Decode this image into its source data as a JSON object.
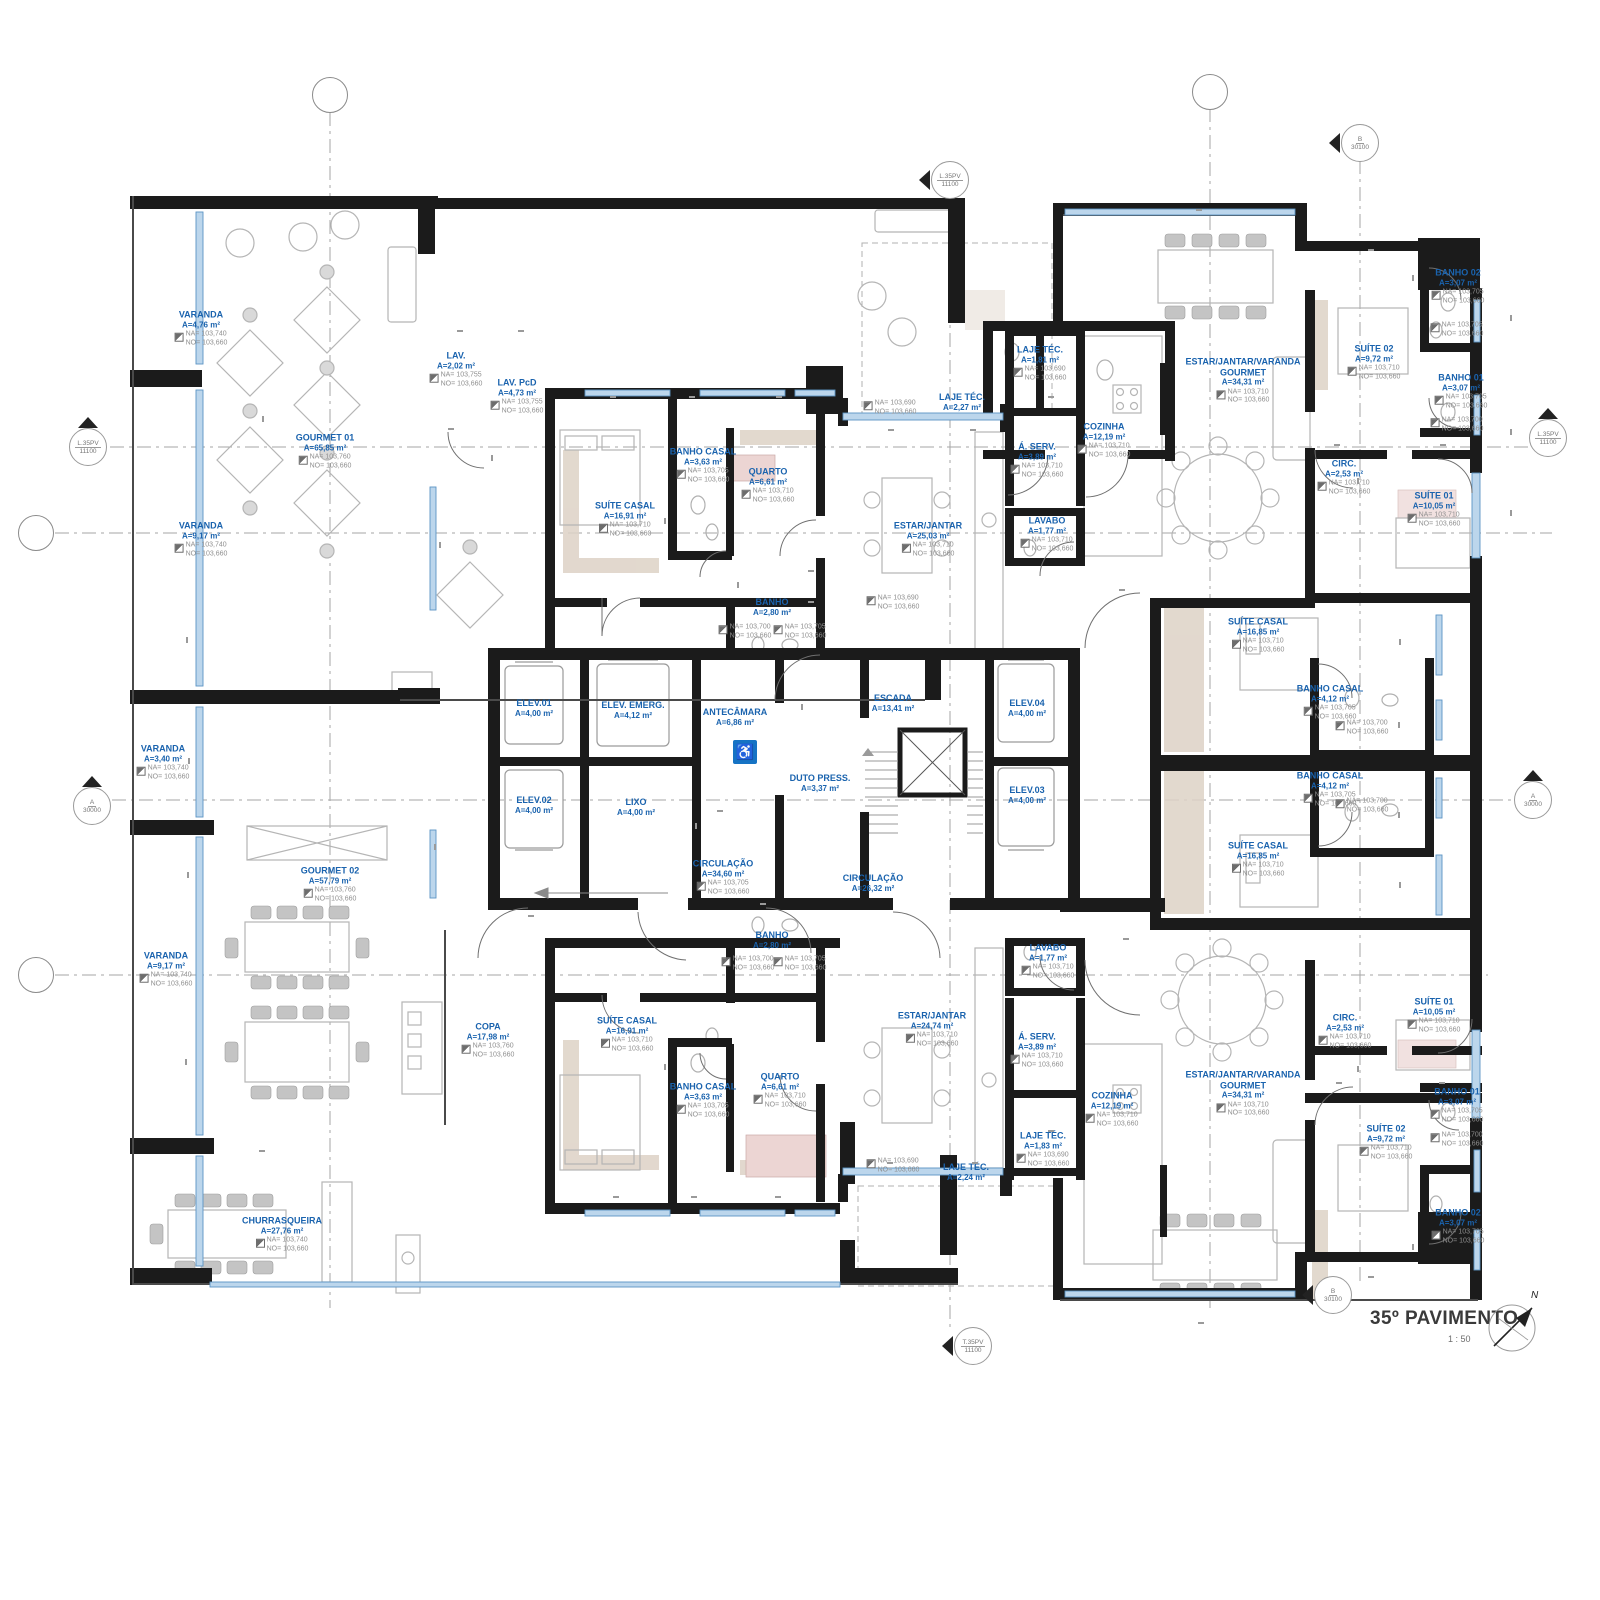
{
  "titleblock": {
    "title": "35º PAVIMENTO",
    "scale": "1 : 50",
    "north": "N"
  },
  "rooms": [
    {
      "name": "VARANDA",
      "area": "A=4,76 m²",
      "na": "NA= 103,740",
      "no": "NO= 103,660",
      "x": 201,
      "y": 329
    },
    {
      "name": "GOURMET 01",
      "area": "A=65,85 m²",
      "na": "NA= 103,760",
      "no": "NO= 103,660",
      "x": 325,
      "y": 452
    },
    {
      "name": "VARANDA",
      "area": "A=9,17 m²",
      "na": "NA= 103,740",
      "no": "NO= 103,660",
      "x": 201,
      "y": 540
    },
    {
      "name": "LAV.",
      "area": "A=2,02 m²",
      "na": "NA= 103,755",
      "no": "NO= 103,660",
      "x": 456,
      "y": 370
    },
    {
      "name": "LAV. PcD",
      "area": "A=4,73 m²",
      "na": "NA= 103,755",
      "no": "NO= 103,660",
      "x": 517,
      "y": 397
    },
    {
      "name": "VARANDA",
      "area": "A=3,40 m²",
      "na": "NA= 103,740",
      "no": "NO= 103,660",
      "x": 163,
      "y": 763
    },
    {
      "name": "GOURMET 02",
      "area": "A=57,79 m²",
      "na": "NA= 103,760",
      "no": "NO= 103,660",
      "x": 330,
      "y": 885
    },
    {
      "name": "VARANDA",
      "area": "A=9,17 m²",
      "na": "NA= 103,740",
      "no": "NO= 103,660",
      "x": 166,
      "y": 970
    },
    {
      "name": "COPA",
      "area": "A=17,98 m²",
      "na": "NA= 103,760",
      "no": "NO= 103,660",
      "x": 488,
      "y": 1041
    },
    {
      "name": "CHURRASQUEIRA",
      "area": "A=27,76 m²",
      "na": "NA= 103,740",
      "no": "NO= 103,660",
      "x": 282,
      "y": 1235
    },
    {
      "name": "SUÍTE CASAL",
      "area": "A=16,91 m²",
      "na": "NA= 103,710",
      "no": "NO= 103,660",
      "x": 625,
      "y": 520
    },
    {
      "name": "BANHO CASAL",
      "area": "A=3,63 m²",
      "na": "NA= 103,705",
      "no": "NO= 103,660",
      "x": 703,
      "y": 466
    },
    {
      "name": "QUARTO",
      "area": "A=6,61 m²",
      "na": "NA= 103,710",
      "no": "NO= 103,660",
      "x": 768,
      "y": 486
    },
    {
      "name": "BANHO",
      "area": "A=2,80 m²",
      "x": 772,
      "y": 607
    },
    {
      "name": "ESTAR/JANTAR",
      "area": "A=25,03 m²",
      "na": "NA= 103,710",
      "no": "NO= 103,660",
      "x": 928,
      "y": 540
    },
    {
      "name": "LAJE TÉC.",
      "area": "A=2,27 m²",
      "x": 962,
      "y": 402
    },
    {
      "name": "LAJE TÉC.",
      "area": "A=1,81 m²",
      "na": "NA= 103,690",
      "no": "NO= 103,660",
      "x": 1040,
      "y": 364
    },
    {
      "name": "Á. SERV.",
      "area": "A=3,89 m²",
      "na": "NA= 103,710",
      "no": "NO= 103,660",
      "x": 1037,
      "y": 461
    },
    {
      "name": "COZINHA",
      "area": "A=12,19 m²",
      "na": "NA= 103,710",
      "no": "NO= 103,660",
      "x": 1104,
      "y": 441
    },
    {
      "name": "LAVABO",
      "area": "A=1,77 m²",
      "na": "NA= 103,710",
      "no": "NO= 103,660",
      "x": 1047,
      "y": 535
    },
    {
      "name": "ESTAR/JANTAR/VARANDA\nGOURMET",
      "area": "A=34,31 m²",
      "na": "NA= 103,710",
      "no": "NO= 103,660",
      "x": 1243,
      "y": 381
    },
    {
      "name": "SUÍTE CASAL",
      "area": "A=16,85 m²",
      "na": "NA= 103,710",
      "no": "NO= 103,660",
      "x": 1258,
      "y": 636
    },
    {
      "name": "BANHO CASAL",
      "area": "A=4,12 m²",
      "na": "NA= 103,705",
      "no": "NO= 103,660",
      "x": 1330,
      "y": 703
    },
    {
      "name": "BANHO CASAL",
      "area": "A=4,12 m²",
      "na": "NA= 103,705",
      "no": "NO= 103,660",
      "x": 1330,
      "y": 790
    },
    {
      "name": "SUÍTE CASAL",
      "area": "A=16,85 m²",
      "na": "NA= 103,710",
      "no": "NO= 103,660",
      "x": 1258,
      "y": 860
    },
    {
      "name": "BANHO 02",
      "area": "A=3,07 m²",
      "na": "NA= 103,705",
      "no": "NO= 103,660",
      "x": 1458,
      "y": 287
    },
    {
      "name": "SUÍTE 02",
      "area": "A=9,72 m²",
      "na": "NA= 103,710",
      "no": "NO= 103,660",
      "x": 1374,
      "y": 363
    },
    {
      "name": "BANHO 01",
      "area": "A=3,07 m²",
      "na": "NA= 103,705",
      "no": "NO= 103,660",
      "x": 1461,
      "y": 392
    },
    {
      "name": "CIRC.",
      "area": "A=2,53 m²",
      "na": "NA= 103,710",
      "no": "NO= 103,660",
      "x": 1344,
      "y": 478
    },
    {
      "name": "SUÍTE 01",
      "area": "A=10,05 m²",
      "na": "NA= 103,710",
      "no": "NO= 103,660",
      "x": 1434,
      "y": 510
    },
    {
      "name": "ELEV.01",
      "area": "A=4,00 m²",
      "x": 534,
      "y": 708
    },
    {
      "name": "ELEV. EMERG.",
      "area": "A=4,12 m²",
      "x": 633,
      "y": 710
    },
    {
      "name": "ANTECÂMARA",
      "area": "A=6,86 m²",
      "x": 735,
      "y": 717
    },
    {
      "name": "ESCADA",
      "area": "A=13,41 m²",
      "x": 893,
      "y": 703
    },
    {
      "name": "ELEV.02",
      "area": "A=4,00 m²",
      "x": 534,
      "y": 805
    },
    {
      "name": "LIXO",
      "area": "A=4,00 m²",
      "x": 636,
      "y": 807
    },
    {
      "name": "DUTO PRESS.",
      "area": "A=3,37 m²",
      "x": 820,
      "y": 783
    },
    {
      "name": "ELEV.04",
      "area": "A=4,00 m²",
      "x": 1027,
      "y": 708
    },
    {
      "name": "ELEV.03",
      "area": "A=4,00 m²",
      "x": 1027,
      "y": 795
    },
    {
      "name": "CIRCULAÇÃO",
      "area": "A=34,60 m²",
      "na": "NA= 103,705",
      "no": "NO= 103,660",
      "x": 723,
      "y": 878
    },
    {
      "name": "CIRCULAÇÃO",
      "area": "A=26,32 m²",
      "x": 873,
      "y": 883
    },
    {
      "name": "BANHO",
      "area": "A=2,80 m²",
      "x": 772,
      "y": 940
    },
    {
      "name": "SUÍTE CASAL",
      "area": "A=16,91 m²",
      "na": "NA= 103,710",
      "no": "NO= 103,660",
      "x": 627,
      "y": 1035
    },
    {
      "name": "BANHO CASAL",
      "area": "A=3,63 m²",
      "na": "NA= 103,705",
      "no": "NO= 103,660",
      "x": 703,
      "y": 1101
    },
    {
      "name": "QUARTO",
      "area": "A=6,61 m²",
      "na": "NA= 103,710",
      "no": "NO= 103,660",
      "x": 780,
      "y": 1091
    },
    {
      "name": "ESTAR/JANTAR",
      "area": "A=24,74 m²",
      "na": "NA= 103,710",
      "no": "NO= 103,660",
      "x": 932,
      "y": 1030
    },
    {
      "name": "LAJE TÉC.",
      "area": "A=2,24 m²",
      "x": 966,
      "y": 1172
    },
    {
      "name": "LAVABO",
      "area": "A=1,77 m²",
      "na": "NA= 103,710",
      "no": "NO= 103,660",
      "x": 1048,
      "y": 962
    },
    {
      "name": "Á. SERV.",
      "area": "A=3,89 m²",
      "na": "NA= 103,710",
      "no": "NO= 103,660",
      "x": 1037,
      "y": 1051
    },
    {
      "name": "COZINHA",
      "area": "A=12,19 m²",
      "na": "NA= 103,710",
      "no": "NO= 103,660",
      "x": 1112,
      "y": 1110
    },
    {
      "name": "LAJE TÉC.",
      "area": "A=1,83 m²",
      "na": "NA= 103,690",
      "no": "NO= 103,660",
      "x": 1043,
      "y": 1150
    },
    {
      "name": "ESTAR/JANTAR/VARANDA\nGOURMET",
      "area": "A=34,31 m²",
      "na": "NA= 103,710",
      "no": "NO= 103,660",
      "x": 1243,
      "y": 1094
    },
    {
      "name": "CIRC.",
      "area": "A=2,53 m²",
      "na": "NA= 103,710",
      "no": "NO= 103,660",
      "x": 1345,
      "y": 1032
    },
    {
      "name": "SUÍTE 01",
      "area": "A=10,05 m²",
      "na": "NA= 103,710",
      "no": "NO= 103,660",
      "x": 1434,
      "y": 1016
    },
    {
      "name": "SUÍTE 02",
      "area": "A=9,72 m²",
      "na": "NA= 103,710",
      "no": "NO= 103,660",
      "x": 1386,
      "y": 1143
    },
    {
      "name": "BANHO 01",
      "area": "A=3,07 m²",
      "na": "NA= 103,705",
      "no": "NO= 103,660",
      "x": 1457,
      "y": 1106
    },
    {
      "name": "BANHO 02",
      "area": "A=3,07 m²",
      "na": "NA= 103,705",
      "no": "NO= 103,660",
      "x": 1458,
      "y": 1227
    }
  ],
  "levels": [
    {
      "na": "NA= 103,700",
      "no": "NO= 103,660",
      "x": 745,
      "y": 632
    },
    {
      "na": "NA= 103,705",
      "no": "NO= 103,660",
      "x": 800,
      "y": 632
    },
    {
      "na": "NA= 103,700",
      "no": "NO= 103,660",
      "x": 748,
      "y": 964
    },
    {
      "na": "NA= 103,705",
      "no": "NO= 103,660",
      "x": 800,
      "y": 964
    },
    {
      "na": "NA= 103,700",
      "no": "NO= 103,660",
      "x": 1362,
      "y": 728
    },
    {
      "na": "NA= 103,700",
      "no": "NO= 103,660",
      "x": 1362,
      "y": 806
    },
    {
      "na": "NA= 103,690",
      "no": "NO= 103,660",
      "x": 893,
      "y": 603
    },
    {
      "na": "NA= 103,690",
      "no": "NO= 103,660",
      "x": 893,
      "y": 1166
    },
    {
      "na": "NA= 103,690",
      "no": "NO= 103,660",
      "x": 890,
      "y": 408
    },
    {
      "na": "NA= 103,705",
      "no": "NO= 103,660",
      "x": 1457,
      "y": 330
    },
    {
      "na": "NA= 103,700",
      "no": "NO= 103,660",
      "x": 1457,
      "y": 425
    },
    {
      "na": "NA= 103,700",
      "no": "NO= 103,660",
      "x": 1457,
      "y": 1140
    }
  ],
  "annotations": [
    {
      "text": "OS ELEVADORES DEVERÃO SEGUIR\nAS RECOMENDAÇÕES PREVISTAS\nNA NORMA NM 313/07",
      "x": 665,
      "y": 252
    },
    {
      "text": "OS ELEVADORES\nDEVERÃO SEGUIR AS\nRECOMENDAÇÕES\nPREVISTAS NA NORMA NM\n313/07",
      "x": 1498,
      "y": 747
    },
    {
      "text": "GUARDA-CORPO\nH=1,20m\nMURETA H=0,60m\nGRADIL H=0,60m",
      "x": 886,
      "y": 320
    },
    {
      "text": "GUARDA-CORPO\nH=1,20m\nMURETA H=0,20m\nGRADIL H=1,00m",
      "x": 976,
      "y": 320
    },
    {
      "text": "GUARDA-CORPO H=1,20m\nMURETA H=0,20m\nGRADIL H=1,00m",
      "x": 1000,
      "y": 252
    },
    {
      "text": "GUARDA-CORPO\nH=1,20m\nMURETA H=0,60m\nGRADIL H=0,60m",
      "x": 886,
      "y": 1253
    },
    {
      "text": "GUARDA-CORPO\nH=1,20m\nMURETA H=0,20m\nGRADIL H=1,00m",
      "x": 976,
      "y": 1253
    },
    {
      "text": "GUARDA-CORPO H=1,20m\nMURETA H=0,20m\nGRADIL H=1,00m",
      "x": 1000,
      "y": 1302
    },
    {
      "text": "VENTILAÇÃO\nMECÂNICA",
      "x": 866,
      "y": 629
    },
    {
      "text": "VENTILAÇÃO\nMECÂNICA",
      "x": 1133,
      "y": 536
    },
    {
      "text": "VENTILAÇÃO\nMECÂNICA",
      "x": 870,
      "y": 966
    },
    {
      "text": "VENTILAÇÃO\nMECÂNICA",
      "x": 1133,
      "y": 998
    },
    {
      "text": "REF",
      "x": 407,
      "y": 687
    },
    {
      "text": "SOBE\ni=2,75%",
      "x": 600,
      "y": 896
    },
    {
      "text": "SOBE",
      "x": 868,
      "y": 739
    },
    {
      "text": "DESCE",
      "x": 916,
      "y": 706,
      "v": 1
    },
    {
      "text": "A=14,37m²",
      "x": 884,
      "y": 512,
      "v": 1
    }
  ],
  "tags": [
    {
      "t": "P22",
      "x": 263,
      "y": 419,
      "v": 1
    },
    {
      "t": "P22",
      "x": 187,
      "y": 640,
      "v": 1
    },
    {
      "t": "P23",
      "x": 189,
      "y": 761,
      "v": 1
    },
    {
      "t": "P22",
      "x": 188,
      "y": 875,
      "v": 1
    },
    {
      "t": "P22",
      "x": 186,
      "y": 1062,
      "v": 1
    },
    {
      "t": "P22",
      "x": 262,
      "y": 1151
    },
    {
      "t": "J14",
      "x": 460,
      "y": 331
    },
    {
      "t": "J14",
      "x": 521,
      "y": 331
    },
    {
      "t": "P01",
      "x": 451,
      "y": 429
    },
    {
      "t": "P05",
      "x": 492,
      "y": 458,
      "v": 1
    },
    {
      "t": "P31",
      "x": 440,
      "y": 545,
      "v": 1
    },
    {
      "t": "P31",
      "x": 435,
      "y": 847,
      "v": 1
    },
    {
      "t": "J07",
      "x": 613,
      "y": 397
    },
    {
      "t": "J14",
      "x": 692,
      "y": 397
    },
    {
      "t": "J06",
      "x": 779,
      "y": 397
    },
    {
      "t": "P01",
      "x": 665,
      "y": 521,
      "v": 1
    },
    {
      "t": "P02",
      "x": 738,
      "y": 585,
      "v": 1
    },
    {
      "t": "P02",
      "x": 811,
      "y": 571
    },
    {
      "t": "P01",
      "x": 811,
      "y": 602
    },
    {
      "t": "P22",
      "x": 891,
      "y": 430
    },
    {
      "t": "P27",
      "x": 973,
      "y": 430
    },
    {
      "t": "P27",
      "x": 1051,
      "y": 397
    },
    {
      "t": "P03A",
      "x": 531,
      "y": 916
    },
    {
      "t": "P03A",
      "x": 763,
      "y": 904
    },
    {
      "t": "P08",
      "x": 696,
      "y": 826,
      "v": 1
    },
    {
      "t": "PCF",
      "x": 720,
      "y": 811
    },
    {
      "t": "PCF",
      "x": 802,
      "y": 707,
      "v": 1
    },
    {
      "t": "P04A",
      "x": 1122,
      "y": 590
    },
    {
      "t": "P04A",
      "x": 1126,
      "y": 939
    },
    {
      "t": "J13",
      "x": 1199,
      "y": 210
    },
    {
      "t": "J13",
      "x": 1201,
      "y": 1323
    },
    {
      "t": "J06",
      "x": 1371,
      "y": 250
    },
    {
      "t": "P01",
      "x": 1413,
      "y": 278,
      "v": 1
    },
    {
      "t": "J14",
      "x": 1511,
      "y": 318,
      "v": 1
    },
    {
      "t": "J14",
      "x": 1511,
      "y": 432,
      "v": 1
    },
    {
      "t": "J06",
      "x": 1511,
      "y": 513,
      "v": 1
    },
    {
      "t": "P02",
      "x": 1337,
      "y": 445
    },
    {
      "t": "P01",
      "x": 1443,
      "y": 445
    },
    {
      "t": "P02",
      "x": 1358,
      "y": 481,
      "v": 1
    },
    {
      "t": "J07",
      "x": 1400,
      "y": 642,
      "v": 1
    },
    {
      "t": "J14",
      "x": 1399,
      "y": 725,
      "v": 1
    },
    {
      "t": "J14",
      "x": 1399,
      "y": 815,
      "v": 1
    },
    {
      "t": "J07",
      "x": 1400,
      "y": 885,
      "v": 1
    },
    {
      "t": "P01",
      "x": 665,
      "y": 1067,
      "v": 1
    },
    {
      "t": "J07",
      "x": 616,
      "y": 1197
    },
    {
      "t": "J14",
      "x": 694,
      "y": 1197
    },
    {
      "t": "J06",
      "x": 778,
      "y": 1197
    },
    {
      "t": "P22",
      "x": 890,
      "y": 1163
    },
    {
      "t": "P27",
      "x": 975,
      "y": 1163
    },
    {
      "t": "P27",
      "x": 1051,
      "y": 1131
    },
    {
      "t": "P02",
      "x": 1339,
      "y": 1083
    },
    {
      "t": "P01",
      "x": 1442,
      "y": 1083
    },
    {
      "t": "P02",
      "x": 1358,
      "y": 1069,
      "v": 1
    },
    {
      "t": "P01",
      "x": 1413,
      "y": 1247,
      "v": 1
    },
    {
      "t": "J06",
      "x": 1371,
      "y": 1277
    }
  ],
  "grid_bubbles": [
    {
      "code": "Y1",
      "x": 330,
      "y": 95
    },
    {
      "code": "Y2",
      "x": 1210,
      "y": 92
    },
    {
      "code": "X1",
      "x": 36,
      "y": 533
    },
    {
      "code": "X2",
      "x": 36,
      "y": 975
    }
  ],
  "section_markers": [
    {
      "code": "L.35PV",
      "value": "11100",
      "x": 88,
      "y": 447,
      "tri": "up"
    },
    {
      "code": "L.35PV",
      "value": "11100",
      "x": 1548,
      "y": 438,
      "tri": "up"
    },
    {
      "code": "A",
      "value": "30000",
      "x": 92,
      "y": 806,
      "tri": "up"
    },
    {
      "code": "A",
      "value": "30000",
      "x": 1533,
      "y": 800,
      "tri": "up"
    },
    {
      "code": "B",
      "value": "30100",
      "x": 1360,
      "y": 143,
      "tri": "left"
    },
    {
      "code": "B",
      "value": "30100",
      "x": 1333,
      "y": 1295,
      "tri": "left"
    },
    {
      "code": "L.35PV",
      "value": "11100",
      "x": 950,
      "y": 180,
      "tri": "left"
    },
    {
      "code": "T.35PV",
      "value": "11100",
      "x": 973,
      "y": 1346,
      "tri": "left"
    }
  ]
}
